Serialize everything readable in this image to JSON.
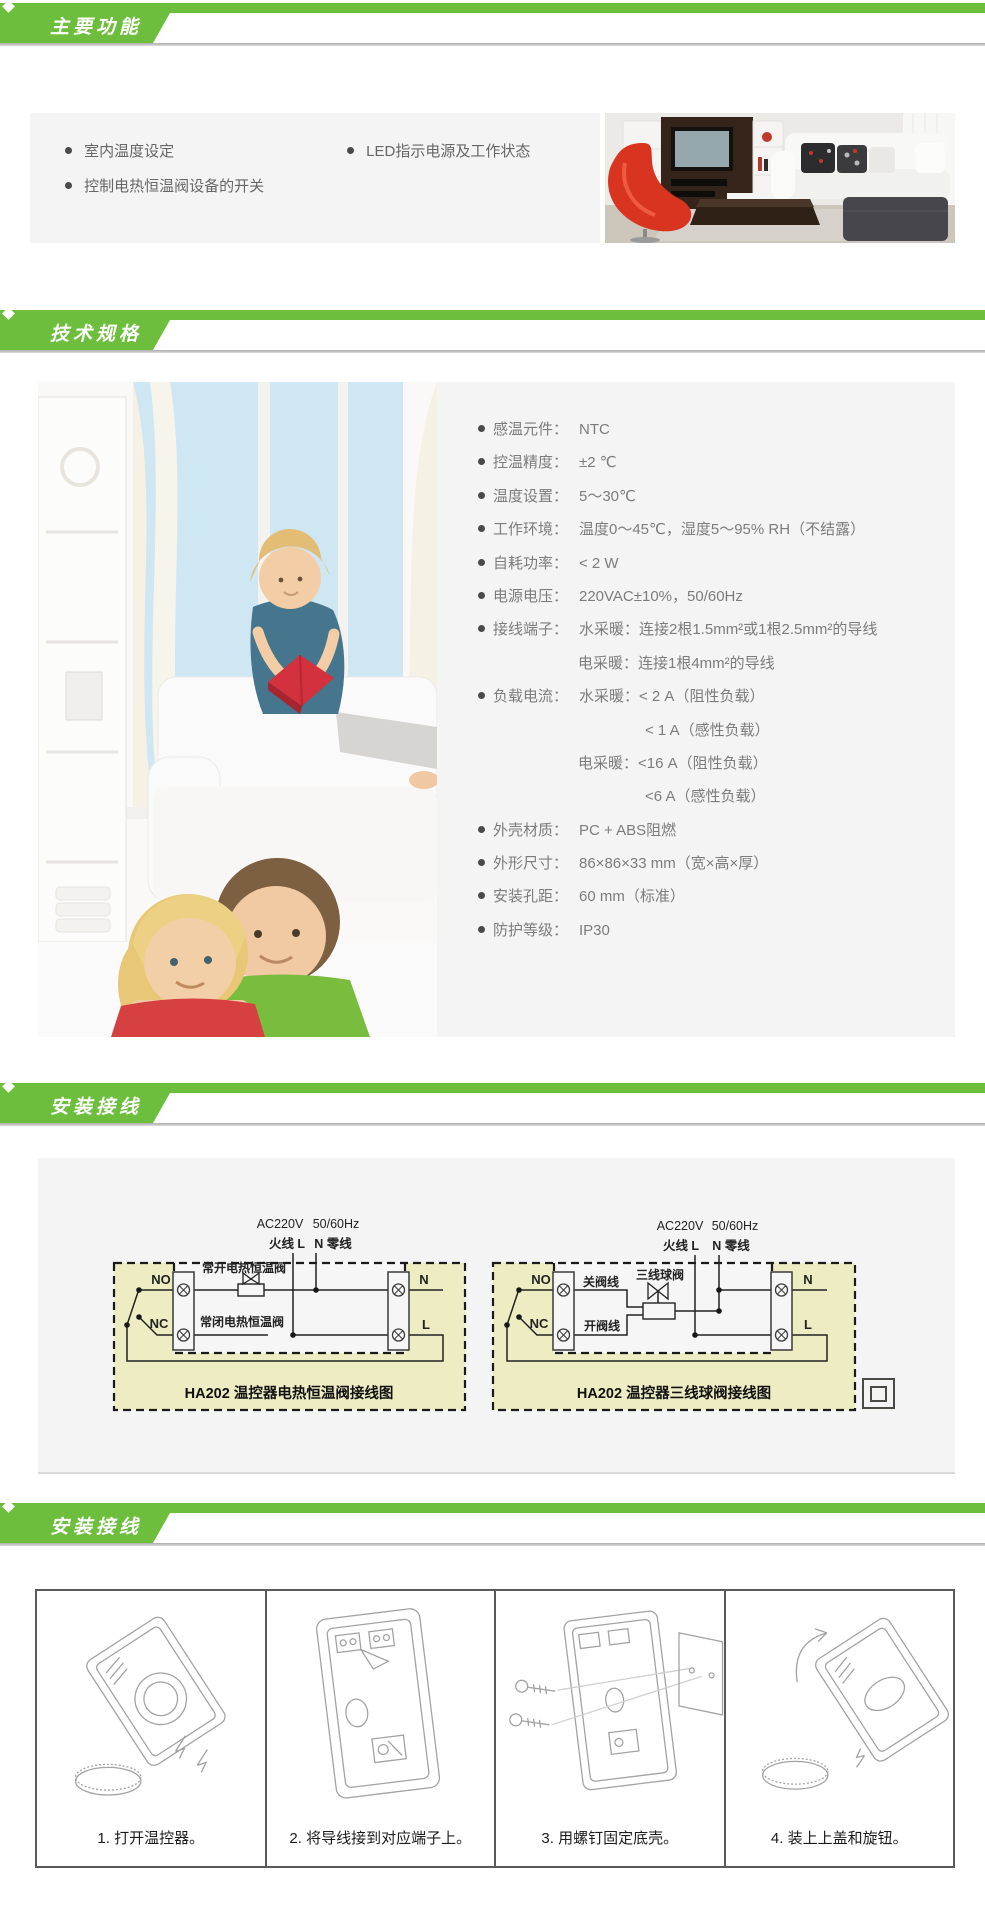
{
  "colors": {
    "green": "#6cbe3c",
    "section_bg": "#f4f4f4",
    "diagram_bg": "#eeecc3",
    "shadow": "#adadad"
  },
  "headers": {
    "features": "主要功能",
    "specs": "技术规格",
    "wiring": "安装接线",
    "install": "安装接线"
  },
  "features": {
    "items": [
      "室内温度设定",
      "控制电热恒温阀设备的开关",
      "LED指示电源及工作状态"
    ]
  },
  "photos": {
    "living_room": "living-room-photo",
    "family": "family-reading-photo"
  },
  "specs": {
    "rows": [
      {
        "label": "感温元件：",
        "value": "NTC"
      },
      {
        "label": "控温精度：",
        "value": "±2 ℃"
      },
      {
        "label": "温度设置：",
        "value": "5～30℃"
      },
      {
        "label": "工作环境：",
        "value": "温度0～45℃，湿度5～95% RH（不结露）"
      },
      {
        "label": "自耗功率：",
        "value": "< 2 W"
      },
      {
        "label": "电源电压：",
        "value": "220VAC±10%，50/60Hz"
      },
      {
        "label": "接线端子：",
        "value": "水采暖：连接2根1.5mm²或1根2.5mm²的导线"
      },
      {
        "label": "",
        "value": "电采暖：连接1根4mm²的导线"
      },
      {
        "label": "负载电流：",
        "value": "水采暖：< 2 A（阻性负载）"
      },
      {
        "label": "",
        "value": "< 1  A（感性负载）"
      },
      {
        "label": "",
        "value": "电采暖：<16 A（阻性负载）"
      },
      {
        "label": "",
        "value": "<6  A（感性负载）"
      },
      {
        "label": "外壳材质：",
        "value": "PC + ABS阻燃"
      },
      {
        "label": "外形尺寸：",
        "value": "86×86×33 mm（宽×高×厚）"
      },
      {
        "label": "安装孔距：",
        "value": "60 mm（标准）"
      },
      {
        "label": "防护等级：",
        "value": "IP30"
      }
    ]
  },
  "wiring": {
    "diagram1": {
      "title": "HA202 温控器电热恒温阀接线图",
      "ac": "AC220V",
      "hz": "50/60Hz",
      "live": "火线 L",
      "neutral": "N 零线",
      "no": "NO",
      "nc": "NC",
      "n": "N",
      "l": "L",
      "valve_no": "常开电热恒温阀",
      "valve_nc": "常闭电热恒温阀"
    },
    "diagram2": {
      "title": "HA202 温控器三线球阀接线图",
      "ac": "AC220V",
      "hz": "50/60Hz",
      "live": "火线 L",
      "neutral": "N 零线",
      "no": "NO",
      "nc": "NC",
      "n": "N",
      "l": "L",
      "close_wire": "关阀线",
      "open_wire": "开阀线",
      "valve": "三线球阀"
    }
  },
  "install": {
    "steps": [
      {
        "num": "1.",
        "text": "打开温控器。"
      },
      {
        "num": "2.",
        "text": "将导线接到对应端子上。"
      },
      {
        "num": "3.",
        "text": "用螺钉固定底壳。"
      },
      {
        "num": "4.",
        "text": "装上上盖和旋钮。"
      }
    ]
  }
}
